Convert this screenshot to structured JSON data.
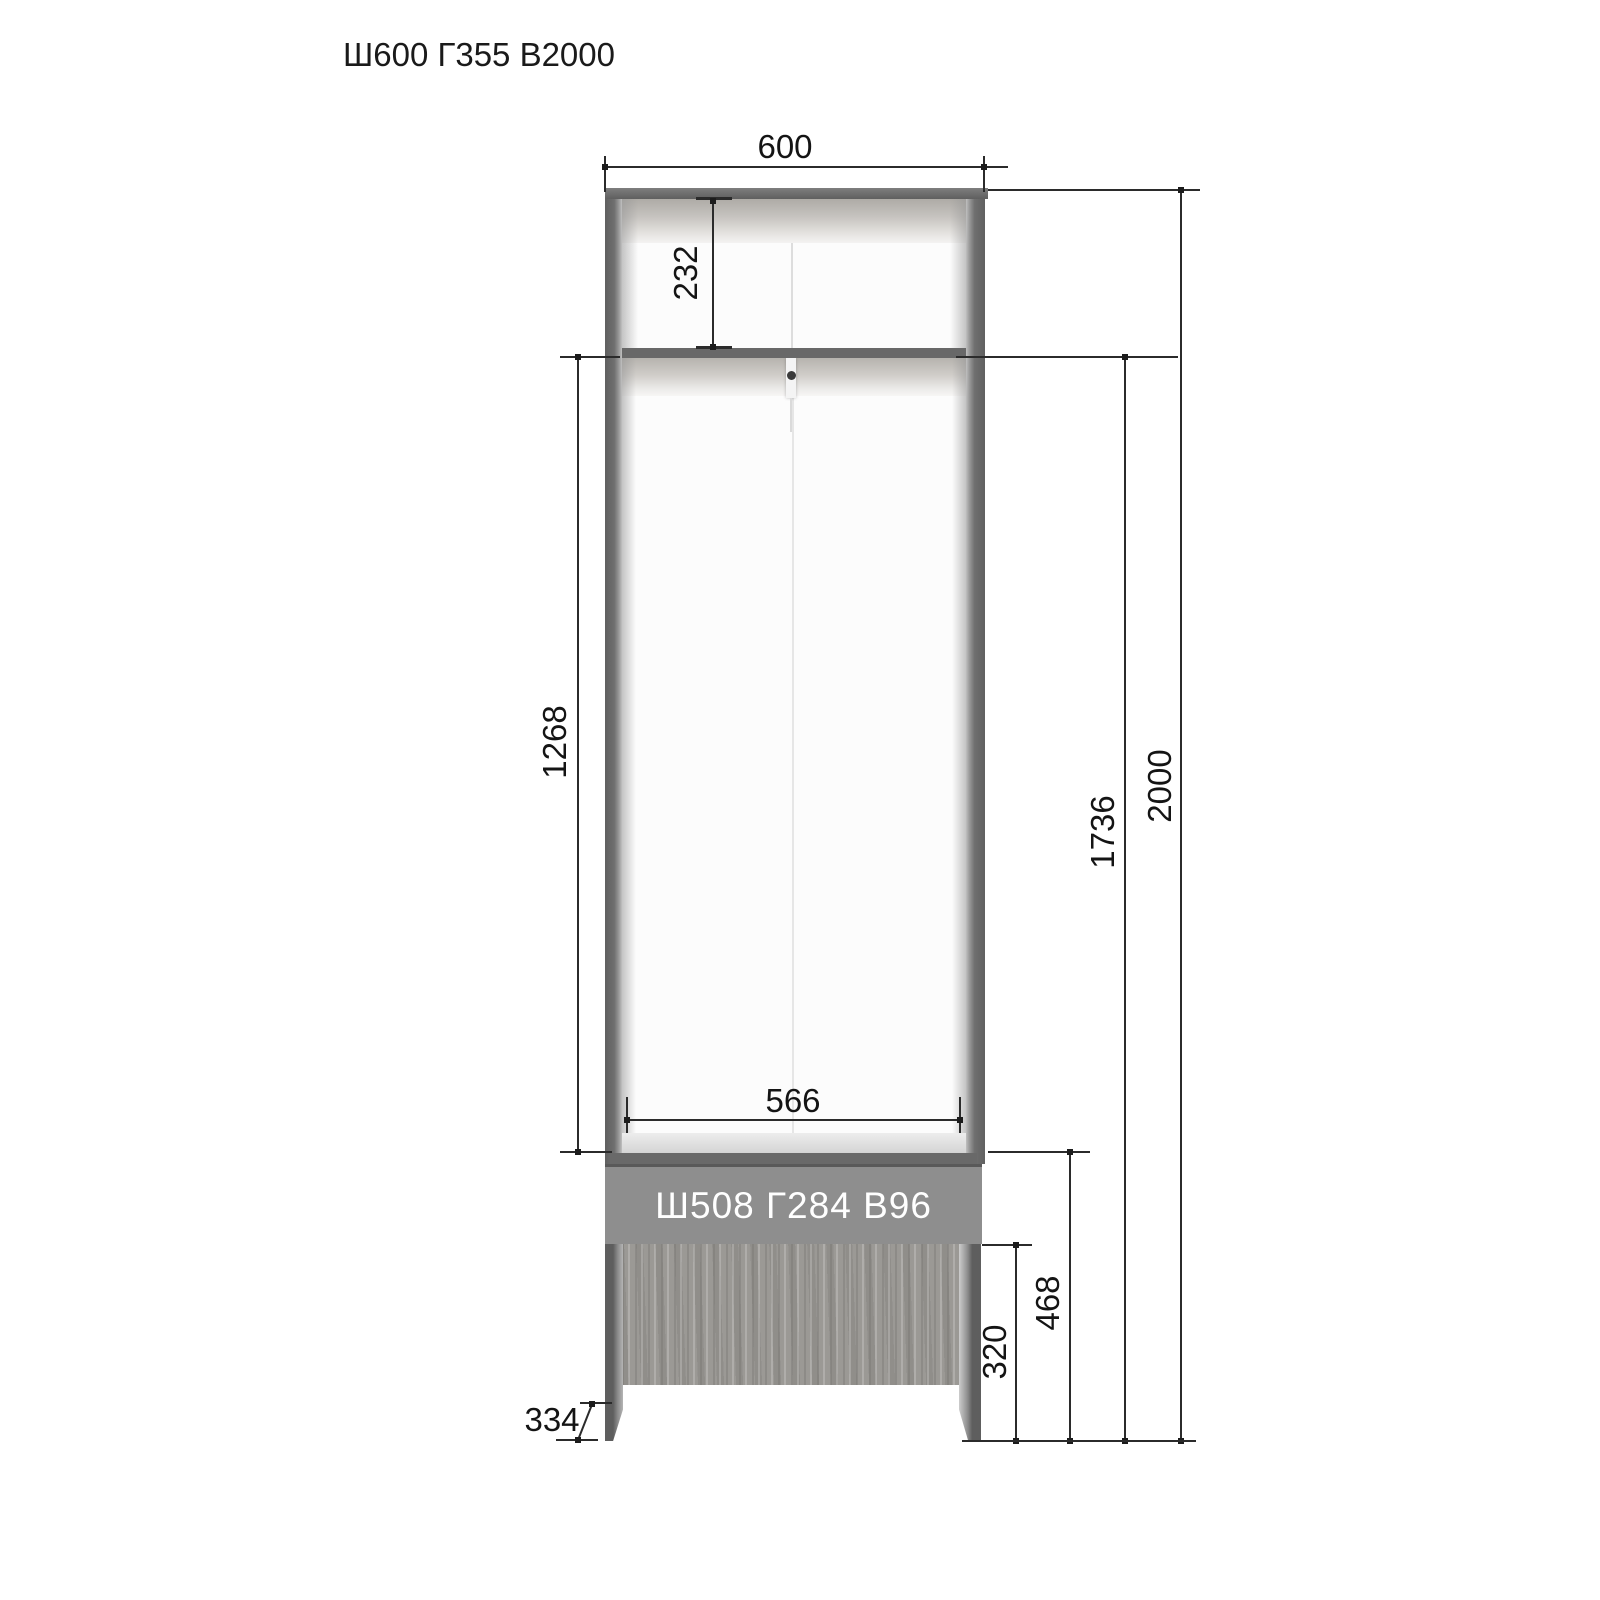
{
  "page": {
    "title": "Ш600 Г355 В2000"
  },
  "cabinet": {
    "drawer_label": "Ш508 Г284 В96",
    "dimensions": {
      "overall_width": "600",
      "top_compartment_height": "232",
      "hanging_section_height": "1268",
      "interior_width": "566",
      "interior_total_height": "1736",
      "overall_height": "2000",
      "base_section_height": "468",
      "leg_opening_height": "320",
      "base_depth": "334"
    }
  },
  "colors": {
    "panel_gray": "#6a6a6a",
    "drawer_band_gray": "#8e8e8e",
    "wood_tone": "#9b9995",
    "dimension_line": "#2b2b2b",
    "dimension_text": "#141414",
    "drawer_label_text": "#ffffff",
    "background": "#ffffff"
  }
}
